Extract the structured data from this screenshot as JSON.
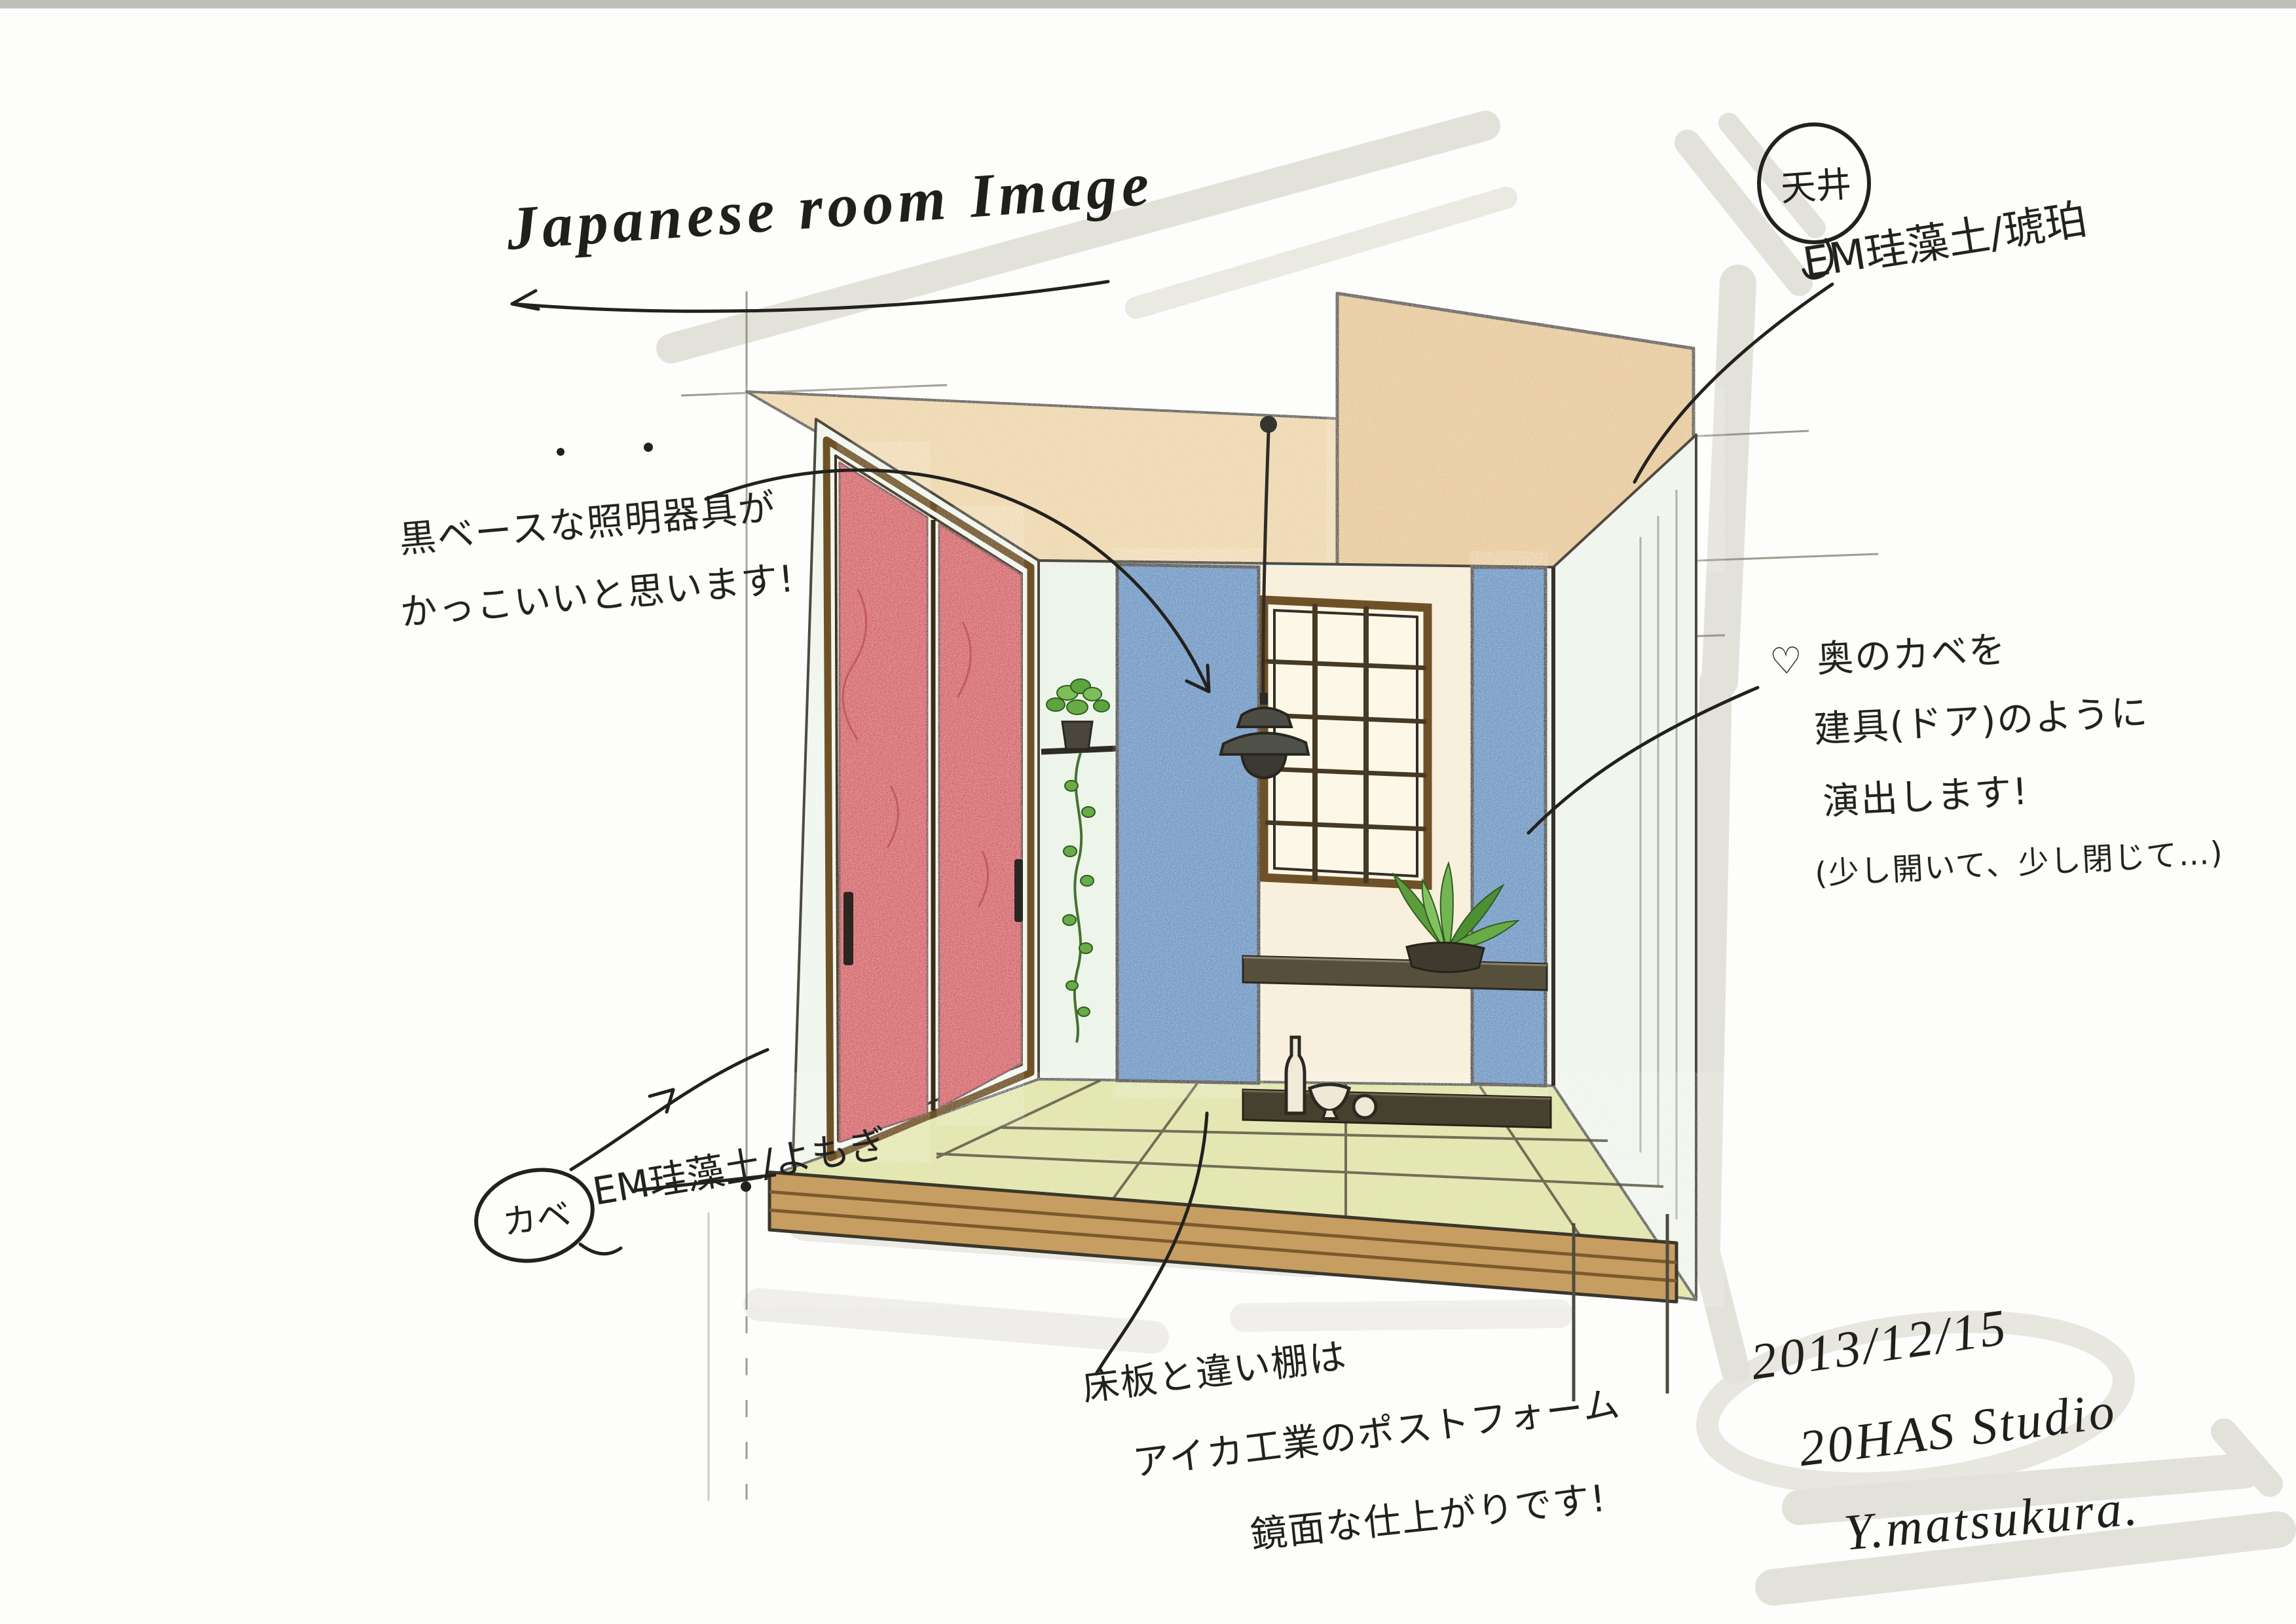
{
  "title": "Japanese room Image",
  "annotations": {
    "ceiling": {
      "label": "天井",
      "material": "EM珪藻土/琥珀"
    },
    "lighting": {
      "line1": "黒ベースな照明器具が",
      "line2": "かっこいいと思います!"
    },
    "back_wall": {
      "heart": "♡",
      "line1": "奥のカベを",
      "line2": "建具(ドア)のように",
      "line3": "演出します!",
      "line4": "(少し開いて、少し閉じて…)"
    },
    "wall": {
      "label": "カベ",
      "material": "EM珪藻土/よもぎ"
    },
    "floor": {
      "line1": "床板と違い棚は",
      "line2": "アイカ工業のポストフォーム",
      "line3": "鏡面な仕上がりです!"
    }
  },
  "signature": {
    "date": "2013/12/15",
    "studio": "20HAS Studio",
    "name": "Y.matsukura."
  },
  "colors": {
    "ink": "#23211d",
    "marker_gray": "#c9c6b9",
    "door_red": "#d4525a",
    "wall_blue": "#5e92c2",
    "ceiling_tan": "#eed5a8",
    "panel_tan": "#e7c794",
    "tatami_green": "#dfe3a2",
    "wood_brown": "#c79e61",
    "frame_brown": "#6f5128",
    "wall_mint": "#edf4ea",
    "alcove_cream": "#f8f0dd",
    "dark_board": "#46402f",
    "leaf_green": "#69ab47"
  }
}
